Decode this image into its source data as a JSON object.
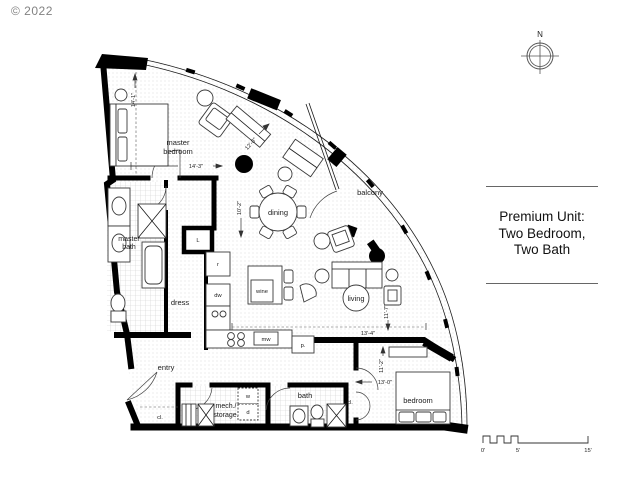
{
  "copyright": "© 2022",
  "compass": {
    "north": "N"
  },
  "info_panel": {
    "line1": "Premium Unit:",
    "line2": "Two Bedroom,",
    "line3": "Two Bath"
  },
  "scale_bar": {
    "zero": "0'",
    "five": "5'",
    "fifteen": "15'"
  },
  "rooms": {
    "master_bedroom": {
      "line1": "master",
      "line2": "bedroom"
    },
    "master_bath": {
      "line1": "master",
      "line2": "bath"
    },
    "dress": {
      "label": "dress"
    },
    "entry": {
      "label": "entry"
    },
    "dining": {
      "label": "dining"
    },
    "balcony": {
      "label": "balcony"
    },
    "living": {
      "label": "living"
    },
    "mech_storage": {
      "line1": "mech./",
      "line2": "storage."
    },
    "bath": {
      "label": "bath"
    },
    "bedroom": {
      "label": "bedroom"
    }
  },
  "closets": {
    "entry_closet": "cl.",
    "hall_closet": "cl."
  },
  "appliances": {
    "refrigerator": "r",
    "dishwasher": "dw",
    "wine_fridge": "wine",
    "microwave": "mw",
    "pantry": "p.",
    "washer": "w",
    "dryer": "d",
    "linen": "L"
  },
  "dimensions": {
    "master_bedroom_width": "14'-3\"",
    "master_bedroom_depth": "14'-1\"",
    "master_closet": "12'-8\"",
    "dining_depth": "10'-2\"",
    "living_width": "13'-4\"",
    "living_depth": "11'-7\"",
    "bedroom_width": "13'-0\"",
    "bedroom_depth": "11'-2\""
  },
  "colors": {
    "ink": "#000000",
    "muted": "#828282"
  }
}
